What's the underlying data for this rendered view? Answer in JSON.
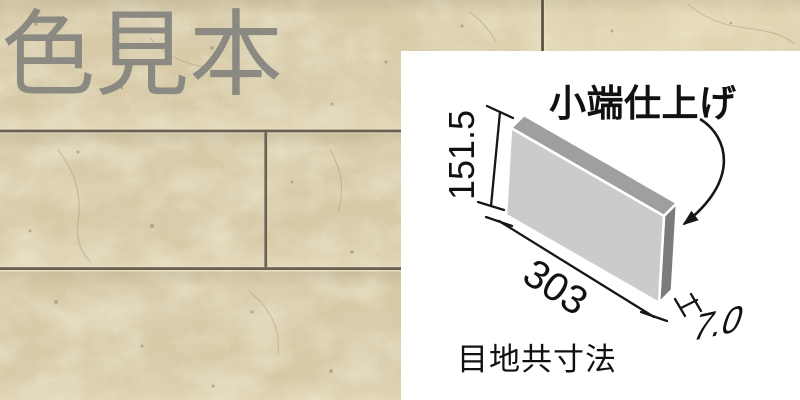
{
  "sample_label": {
    "text": "色見本",
    "color": "#8a8a83"
  },
  "spec_panel": {
    "background": "#ffffff",
    "edge_finish_label": "小端仕上げ",
    "joint_note_label": "目地共寸法",
    "dimensions": {
      "height_mm": "151.5",
      "width_mm": "303",
      "thickness_mm": "7.0"
    },
    "diagram_colors": {
      "tile_face": "#cbcbcb",
      "tile_top_edge": "#9f9f9f",
      "tile_side_edge": "#7b7b7b",
      "line": "#161616"
    }
  },
  "tile_wall": {
    "base_color": "#d7caa6",
    "grout_color": "#6b6152"
  }
}
